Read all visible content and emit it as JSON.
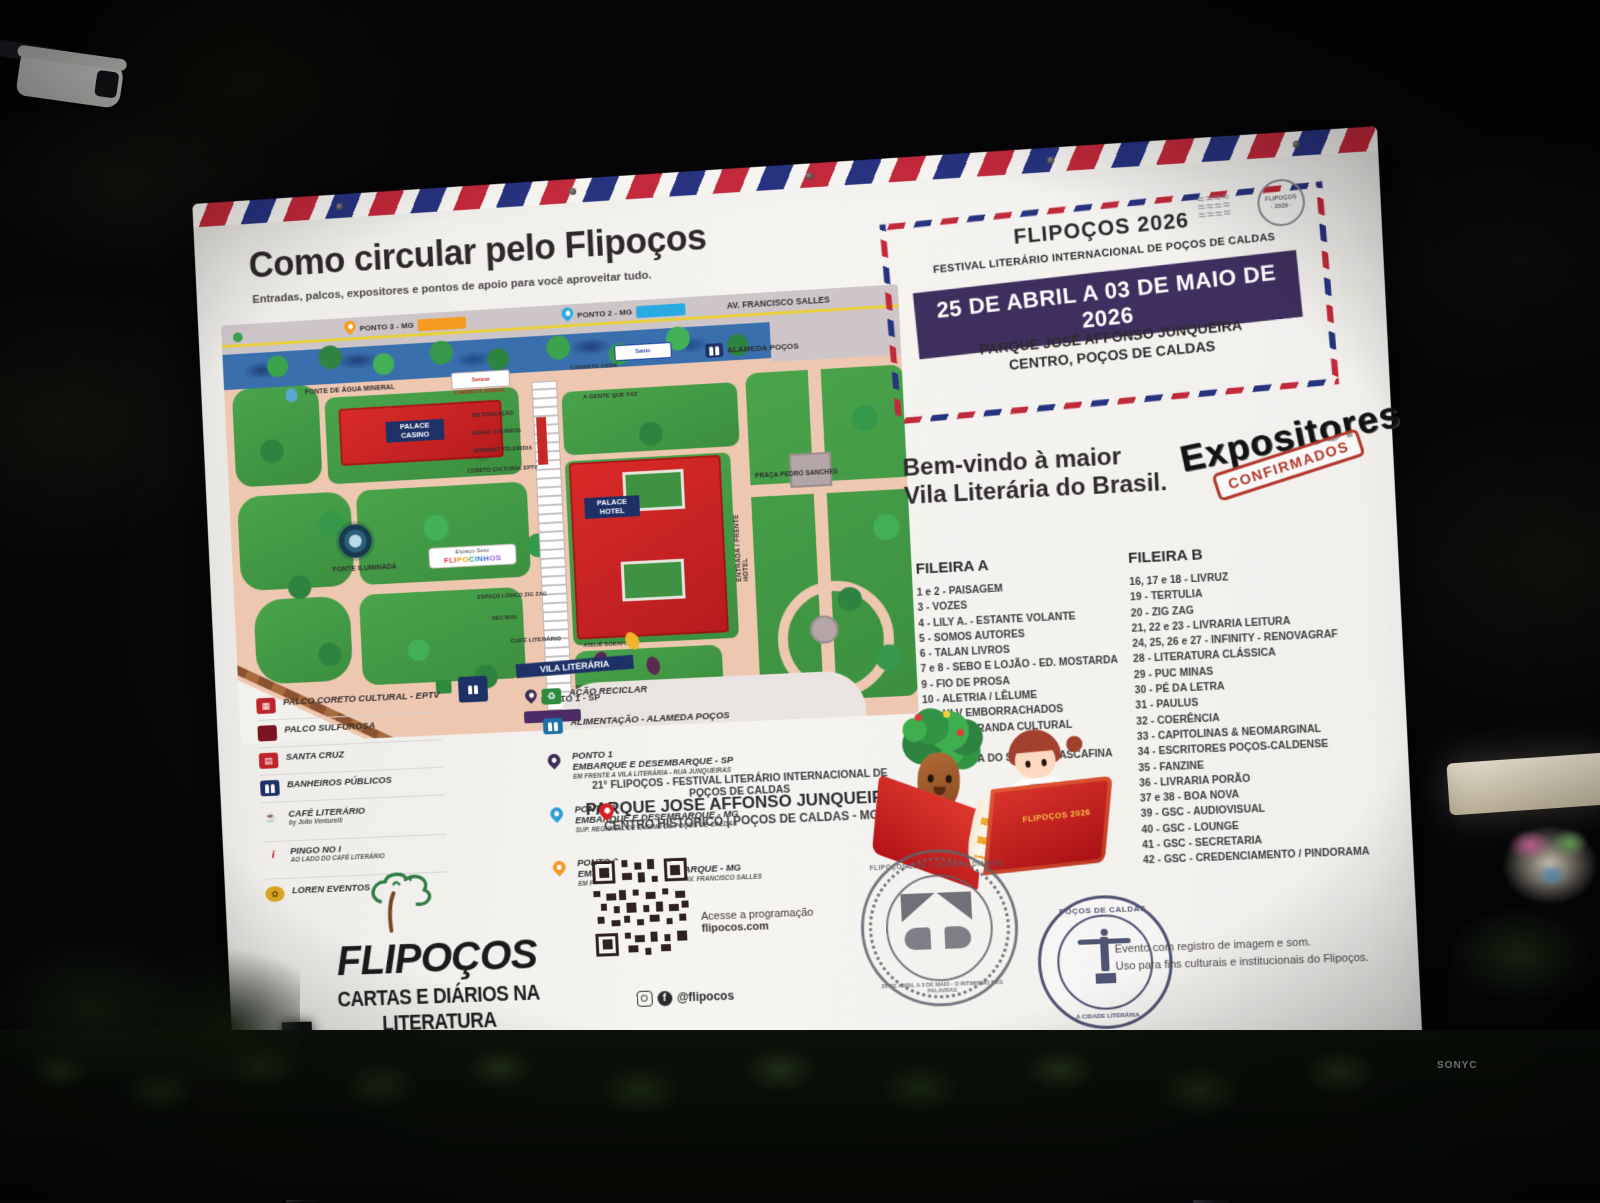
{
  "scene": {
    "watermark": "SONYC"
  },
  "board": {
    "title": "Como circular pelo Flipoços",
    "subtitle": "Entradas, palcos, expositores e pontos de apoio para você aproveitar tudo.",
    "map": {
      "ponto3_tag": "PONTO 3 - MG",
      "ponto2_tag": "PONTO 2 - MG",
      "av_francisco_salles": "AV. FRANCISCO SALLES",
      "alameda_pocos": "ALAMEDA POÇOS",
      "fonte_agua": "FONTE DE ÁGUA MINERAL",
      "carreta_senac": "CARRETA SENAC",
      "carreta_geek": "CARRETA GEEK",
      "sponsor_1": "Serasa",
      "sponsor_2": "Santo",
      "mb_educacao": "MB EDUCAÇÃO",
      "movel_churros": "MÓVEL CHURROS",
      "internet_telemidia": "INTERNET TELEMIDIA",
      "coreto_cultural": "CORETO CULTURAL EPTV",
      "gente_que_faz": "A GENTE QUE FAZ",
      "palace_casino": "PALACE CASINO",
      "palace_hotel": "PALACE HOTEL",
      "fonte_iluminada": "FONTE ILUMINADA",
      "espaco_sesc": "Espaço Sesc",
      "flipocinhos": [
        "FLI",
        "PO",
        "CI",
        "NH",
        "OS"
      ],
      "espaco_ludico": "ESPAÇO LÚDICO ZIG ZAG",
      "seu_buu": "SEU BUU",
      "cafe_literario": "CAFÉ LITERÁRIO",
      "acao_reciclar": "AÇÃO RECICLAR",
      "lascaux": "LASCAUX",
      "atelie_dorafume": "ATELIÊ DORAFUME",
      "palco_sulfurosa": "PALCO SULFUROSA",
      "entrada_frente_hotel": "ENTRADA / FRENTE HOTEL",
      "praca_pedro_sanches": "PRAÇA PEDRO SANCHES",
      "vila_literaria": "VILA LITERÁRIA",
      "ponto1_sp": "PONTO 1 - SP"
    },
    "legend": {
      "left": [
        {
          "icon": "stage-eptv-icon",
          "title": "PALCO CORETO CULTURAL - EPTV"
        },
        {
          "icon": "dark-red-square-icon",
          "title": "PALCO SULFUROSA"
        },
        {
          "icon": "tram-icon",
          "title": "SANTA CRUZ"
        },
        {
          "icon": "restroom-icon",
          "title": "BANHEIROS PÚBLICOS"
        },
        {
          "icon": "coffee-icon",
          "title": "CAFÉ LITERÁRIO",
          "sub": "by João Venturelli"
        },
        {
          "icon": "pingo-icon",
          "title": "PINGO NO I",
          "sub": "AO LADO DO CAFÉ LITERÁRIO"
        },
        {
          "icon": "loren-icon",
          "title": "LOREN EVENTOS"
        }
      ],
      "right": [
        {
          "icon": "recycle-icon",
          "title": "AÇÃO RECICLAR"
        },
        {
          "icon": "food-icon",
          "title": "ALIMENTAÇÃO - ALAMEDA POÇOS"
        },
        {
          "icon": "pin-dark-icon",
          "title": "PONTO 1",
          "line2": "EMBARQUE E DESEMBARQUE - SP",
          "sub": "EM FRENTE A VILA LITERÁRIA - RUA JUNQUEIRAS"
        },
        {
          "icon": "pin-blue-icon",
          "title": "PONTO 2",
          "line2": "EMBARQUE E DESEMBARQUE - MG",
          "sub": "SUP. REGIONAL DE ENSINO DE POÇOS DE CALDAS"
        },
        {
          "icon": "pin-orange-icon",
          "title": "PONTO 3",
          "line2": "EMBARQUE E DESEMBARQUE - MG",
          "sub": "EM FRENTE AO HOTEL FLORIDA - AV. FRANCISCO SALLES"
        }
      ]
    },
    "logo": {
      "name": "FLIPOÇOS",
      "tagline": "CARTAS E DIÁRIOS NA LITERATURA",
      "script": "O Intimismo das Palavras"
    },
    "footer_center": {
      "event_line": "21° FLIPOÇOS - FESTIVAL LITERÁRIO INTERNACIONAL DE POÇOS DE CALDAS",
      "venue": "PARQUE JOSÉ AFFONSO JUNQUEIRA",
      "venue_sub": "CENTRO HISTÓRICO | POÇOS DE CALDAS - MG",
      "qr_caption_1": "Acesse a programação",
      "qr_caption_2": "flipocos.com",
      "social": "@flipocos"
    },
    "envelope": {
      "title": "FLIPOÇOS 2026",
      "subtitle": "FESTIVAL LITERÁRIO INTERNACIONAL DE POÇOS DE CALDAS",
      "date": "25 DE ABRIL A 03 DE MAIO DE 2026",
      "venue_1": "PARQUE JOSÉ AFFONSO JUNQUEIRA",
      "venue_2": "CENTRO, POÇOS DE CALDAS",
      "postmark_1": "FLIPOÇOS",
      "postmark_2": "· 2026 ·"
    },
    "welcome": {
      "line1": "Bem-vindo à maior",
      "line2": "Vila Literária do Brasil.",
      "expositores": "Expositores",
      "confirmados": "CONFIRMADOS"
    },
    "expositores": {
      "fileira_a": {
        "title": "FILEIRA A",
        "items": [
          "1 e 2 - PAISAGEM",
          "3 - VOZES",
          "4 - LILY A. - ESTANTE VOLANTE",
          "5 - SOMOS AUTORES",
          "6 - TALAN LIVROS",
          "7 e 8 - SEBO E LOJÃO - ED. MOSTARDA",
          "9 - FIO DE PROSA",
          "10 - ALETRIA / LÊLUME",
          "11 - HLV EMBORRACHADOS",
          "12 e 13 - CIRANDA CULTURAL",
          "14 - NERDS",
          "15 - ED.RUA DO SABÃO / CASCAFINA"
        ]
      },
      "fileira_b": {
        "title": "FILEIRA B",
        "items": [
          "16, 17 e 18 - LIVRUZ",
          "19 - TERTULIA",
          "20 - ZIG ZAG",
          "21, 22 e 23 - LIVRARIA LEITURA",
          "24, 25, 26 e 27 - INFINITY - RENOVAGRAF",
          "28 - LITERATURA CLÁSSICA",
          "29 - PUC MINAS",
          "30 - PÉ DA LETRA",
          "31 - PAULUS",
          "32 - COERÊNCIA",
          "33 - CAPITOLINAS & NEOMARGINAL",
          "34 - ESCRITORES POÇOS-CALDENSE",
          "35 - FANZINE",
          "36 - LIVRARIA PORÃO",
          "37 e 38 - BOA NOVA",
          "39 - GSC - AUDIOVISUAL",
          "40 - GSC - LOUNGE",
          "41 - GSC - SECRETARIA",
          "42 - GSC - CREDENCIAMENTO / PINDORAMA"
        ]
      }
    },
    "stamps": {
      "stamp1_top": "FLIPOÇOS 2026 · CARTAS E DIÁRIOS",
      "stamp1_bottom": "25 DE ABRIL A 3 DE MAIO · O INTIMISMO DAS PALAVRAS",
      "stamp2_top": "POÇOS DE CALDAS",
      "stamp2_bottom": "A CIDADE LITERÁRIA",
      "book_cover": "FLIPOÇOS 2026"
    },
    "notice": {
      "line1": "Evento com registro de imagem e som.",
      "line2": "Uso para fins culturais e institucionais do Flipoços."
    }
  }
}
